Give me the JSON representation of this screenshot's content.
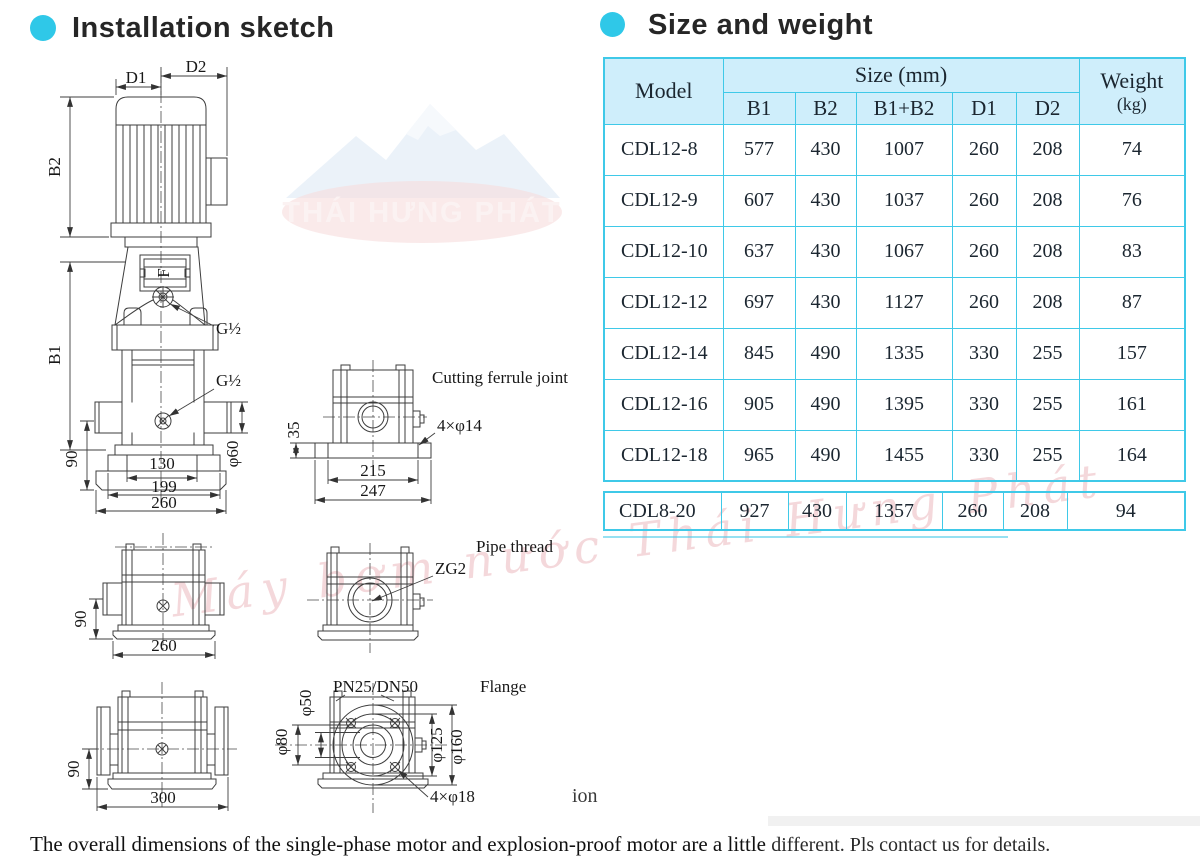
{
  "colors": {
    "accent": "#2fc8e8",
    "table_border": "#3fc9e8",
    "header_bg": "#cfeefb"
  },
  "sections": {
    "installation_title": "Installation sketch",
    "size_weight_title": "Size and weight"
  },
  "table": {
    "header": {
      "model": "Model",
      "size_group": "Size (mm)",
      "b1": "B1",
      "b2": "B2",
      "b1b2": "B1+B2",
      "d1": "D1",
      "d2": "D2",
      "weight_line1": "Weight",
      "weight_line2": "(kg)"
    },
    "rows": [
      {
        "model": "CDL12-8",
        "b1": "577",
        "b2": "430",
        "b1b2": "1007",
        "d1": "260",
        "d2": "208",
        "weight": "74"
      },
      {
        "model": "CDL12-9",
        "b1": "607",
        "b2": "430",
        "b1b2": "1037",
        "d1": "260",
        "d2": "208",
        "weight": "76"
      },
      {
        "model": "CDL12-10",
        "b1": "637",
        "b2": "430",
        "b1b2": "1067",
        "d1": "260",
        "d2": "208",
        "weight": "83"
      },
      {
        "model": "CDL12-12",
        "b1": "697",
        "b2": "430",
        "b1b2": "1127",
        "d1": "260",
        "d2": "208",
        "weight": "87"
      },
      {
        "model": "CDL12-14",
        "b1": "845",
        "b2": "490",
        "b1b2": "1335",
        "d1": "330",
        "d2": "255",
        "weight": "157"
      },
      {
        "model": "CDL12-16",
        "b1": "905",
        "b2": "490",
        "b1b2": "1395",
        "d1": "330",
        "d2": "255",
        "weight": "161"
      },
      {
        "model": "CDL12-18",
        "b1": "965",
        "b2": "490",
        "b1b2": "1455",
        "d1": "330",
        "d2": "255",
        "weight": "164"
      },
      {
        "model": "CDL8-20",
        "b1": "927",
        "b2": "430",
        "b1b2": "1357",
        "d1": "260",
        "d2": "208",
        "weight": "94"
      }
    ]
  },
  "sketch": {
    "main": {
      "d1": "D1",
      "d2": "D2",
      "b1": "B1",
      "b2": "B2",
      "g12_top": "G½",
      "g12_mid": "G½",
      "window_glyph": "F",
      "dim90": "90",
      "phi60": "φ60",
      "dim130": "130",
      "dim199": "199",
      "dim260": "260"
    },
    "ferrule": {
      "title": "Cutting ferrule joint",
      "holes": "4×φ14",
      "dim35": "35",
      "dim215": "215",
      "dim247": "247"
    },
    "thread_side": {
      "dim90": "90",
      "dim260": "260"
    },
    "thread_front": {
      "title": "Pipe thread",
      "port": "ZG2"
    },
    "flange_side": {
      "dim90": "90",
      "dim300": "300"
    },
    "flange_front": {
      "title": "Flange",
      "rating": "PN25/DN50",
      "phi50": "φ50",
      "phi80": "φ80",
      "phi125": "φ125",
      "phi160": "φ160",
      "holes": "4×φ18"
    }
  },
  "watermark": {
    "logo_text": "THÁI HƯNG PHÁT",
    "diagonal_text": "Máy bơm nước Thái Hưng Phát"
  },
  "footnote": {
    "part1": "The overall dimensions of the single-phase motor and explosion-proof motor are a little ",
    "part2": "different. Pls contact us for details."
  },
  "fragment": "ion"
}
